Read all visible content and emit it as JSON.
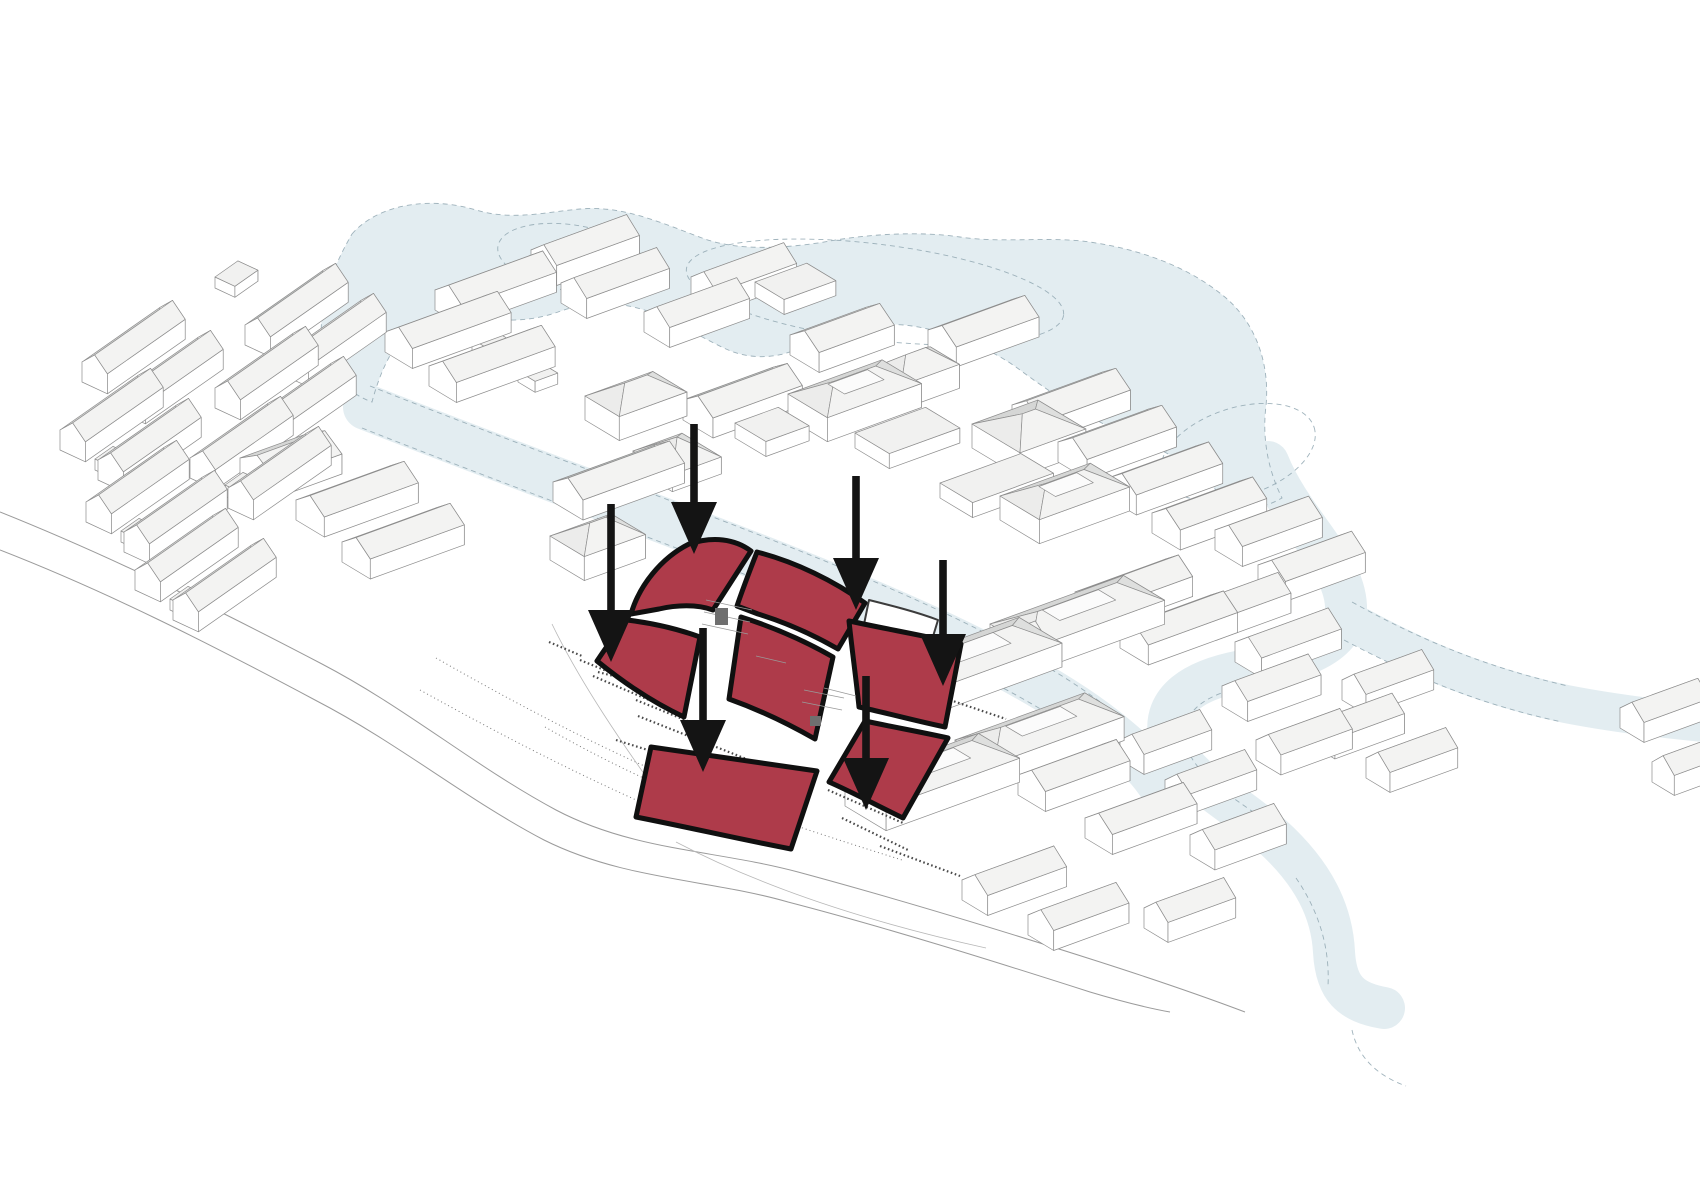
{
  "description": "Axonometric architectural site diagram: white city massing, pale blue lake and river, central site highlighted with red curved roofs and six black arrows",
  "canvas": {
    "w": 1700,
    "h": 1202,
    "background": "#ffffff"
  },
  "palette": {
    "water": "#E3EDF1",
    "water_edge": "#8FA6B0",
    "road": "#9B9B9B",
    "outline": "#8D8D8D",
    "wall": "#FFFFFF",
    "wall_side": "#F6F6F5",
    "roof_near": "#F3F3F2",
    "roof_far": "#D5D6D5",
    "roof_far_dark": "#BFC3C2",
    "roof_hip": "#ECECEB",
    "roof_hip2": "#DEDFDE",
    "roof_top": "#F1F1F0",
    "court": "#FBFBFB",
    "site_red": "#AE3B4A",
    "site_outline": "#101010",
    "arrow": "#141414",
    "detail": "#4A4A4A",
    "dots": "#777777",
    "plinth": "#B8B8B8"
  },
  "iso": {
    "u_deg": -20,
    "v_deg": 31
  },
  "water": {
    "lake": "M 352,234 C 378,204 430,196 476,210 C 512,221 546,212 580,209 C 622,205 662,223 702,238 C 740,252 790,248 830,241 C 870,234 920,231 960,237 C 1000,243 1042,237 1082,241 C 1132,247 1186,264 1226,298 C 1256,324 1270,364 1266,406 C 1262,438 1268,470 1282,498 C 1254,514 1232,508 1216,490 C 1196,468 1168,452 1138,440 C 1098,424 1058,398 1020,370 C 992,349 952,332 912,326 C 872,320 832,332 802,347 C 778,359 750,360 726,349 C 702,338 678,322 650,312 C 618,300 586,302 558,312 C 530,322 500,322 474,316 C 452,311 428,314 410,330 C 392,346 380,372 372,402 C 344,392 326,368 322,344 C 318,308 330,272 352,234 Z",
    "streams": [
      {
        "d": "M 1268,462 C 1292,522 1344,560 1346,606 C 1347,646 1300,660 1242,671 C 1194,680 1163,700 1169,736 C 1176,774 1230,799 1272,836 C 1314,874 1332,912 1334,952 C 1336,988 1350,1002 1384,1008",
        "w": 42
      },
      {
        "d": "M 366,407 C 500,460 644,512 786,568 C 902,614 1030,670 1106,730 C 1136,754 1154,772 1166,794",
        "w": 46
      },
      {
        "d": "M 1348,620 C 1420,660 1486,687 1566,704 C 1612,713 1662,719 1704,723",
        "w": 38
      }
    ],
    "islands": [
      {
        "cx": 572,
        "cy": 258,
        "rx": 75,
        "ry": 33,
        "rot": 9
      },
      {
        "cx": 875,
        "cy": 292,
        "rx": 190,
        "ry": 48,
        "rot": 7
      },
      {
        "cx": 1238,
        "cy": 452,
        "rx": 80,
        "ry": 44,
        "rot": -18
      }
    ],
    "edge_dashes": [
      "M 370,386 C 504,439 648,491 790,547 C 906,593 1034,649 1112,711",
      "M 362,428 C 496,481 640,533 782,589 C 898,635 1026,691 1100,749",
      "M 1352,602 C 1424,642 1490,668 1568,686",
      "M 1344,640 C 1416,678 1482,705 1562,722",
      "M 1238,688 C 1198,698 1180,716 1186,744 C 1194,778 1242,802 1284,834",
      "M 1296,878 C 1318,910 1330,946 1328,986",
      "M 1352,1030 C 1358,1058 1378,1076 1406,1086"
    ]
  },
  "roads": {
    "lines": [
      "M 0,512 C 110,556 215,608 322,664 C 408,709 474,766 556,810 C 634,851 716,850 798,872 C 898,899 1000,930 1100,962 C 1156,980 1208,998 1245,1012",
      "M 0,550 C 108,592 210,644 315,700 C 400,744 464,798 544,840 C 624,880 708,879 788,902 C 888,928 990,960 1090,992 C 1120,1001 1148,1008 1170,1012"
    ],
    "dotted": [
      "M 436,658 C 520,706 600,748 690,786 C 762,816 832,838 902,860",
      "M 545,727 C 620,770 700,806 790,836",
      "M 420,690 C 510,740 592,782 682,820"
    ]
  },
  "buildings": [
    [
      215,
      288,
      28,
      22,
      "f",
      "",
      -35,
      25
    ],
    [
      82,
      382,
      95,
      28,
      "g",
      "",
      -35,
      25
    ],
    [
      120,
      412,
      95,
      28,
      "g",
      "",
      -35,
      25
    ],
    [
      60,
      450,
      95,
      28,
      "g",
      "",
      -35,
      25
    ],
    [
      98,
      480,
      95,
      28,
      "g",
      "",
      -35,
      25
    ],
    [
      86,
      522,
      95,
      28,
      "g",
      "",
      -35,
      25
    ],
    [
      124,
      552,
      95,
      28,
      "g",
      "",
      -35,
      25
    ],
    [
      245,
      345,
      95,
      28,
      "g",
      "d",
      -35,
      25
    ],
    [
      283,
      375,
      95,
      28,
      "g",
      "",
      -35,
      25
    ],
    [
      215,
      408,
      95,
      28,
      "g",
      "",
      -35,
      25
    ],
    [
      253,
      438,
      95,
      28,
      "g",
      "",
      -35,
      25
    ],
    [
      190,
      478,
      95,
      28,
      "g",
      "",
      -35,
      25
    ],
    [
      228,
      508,
      95,
      28,
      "g",
      "",
      -35,
      25
    ],
    [
      135,
      590,
      95,
      28,
      "g",
      "",
      -35,
      25
    ],
    [
      173,
      620,
      95,
      28,
      "g",
      "",
      -35,
      25
    ],
    [
      117,
      402,
      22,
      18,
      "f",
      "",
      -35,
      25
    ],
    [
      95,
      470,
      22,
      18,
      "f",
      "",
      -35,
      25
    ],
    [
      121,
      542,
      22,
      18,
      "f",
      "",
      -35,
      25
    ],
    [
      280,
      365,
      22,
      18,
      "f",
      "",
      -35,
      25
    ],
    [
      250,
      428,
      22,
      18,
      "f",
      "",
      -35,
      25
    ],
    [
      225,
      496,
      22,
      18,
      "f",
      "",
      -35,
      25
    ],
    [
      170,
      610,
      22,
      18,
      "f",
      "",
      -35,
      25
    ],
    [
      240,
      478,
      72,
      40,
      "g",
      ""
    ],
    [
      296,
      520,
      100,
      33,
      "g",
      ""
    ],
    [
      342,
      562,
      100,
      33,
      "g",
      "d"
    ],
    [
      435,
      310,
      100,
      32,
      "g",
      ""
    ],
    [
      385,
      352,
      105,
      32,
      "g",
      ""
    ],
    [
      429,
      386,
      105,
      32,
      "g",
      ""
    ],
    [
      531,
      270,
      88,
      30,
      "g",
      ""
    ],
    [
      561,
      303,
      88,
      30,
      "g",
      ""
    ],
    [
      472,
      350,
      24,
      20,
      "f",
      ""
    ],
    [
      518,
      382,
      24,
      20,
      "f",
      ""
    ],
    [
      644,
      332,
      85,
      30,
      "g",
      ""
    ],
    [
      691,
      297,
      85,
      30,
      "g",
      ""
    ],
    [
      755,
      297,
      55,
      34,
      "f",
      ""
    ],
    [
      553,
      502,
      108,
      35,
      "g",
      "d"
    ],
    [
      550,
      560,
      65,
      40,
      "h",
      ""
    ],
    [
      585,
      420,
      72,
      40,
      "h",
      ""
    ],
    [
      633,
      468,
      52,
      46,
      "p",
      ""
    ],
    [
      683,
      420,
      95,
      35,
      "g",
      "d"
    ],
    [
      735,
      438,
      46,
      36,
      "f",
      ""
    ],
    [
      790,
      355,
      80,
      34,
      "g",
      ""
    ],
    [
      788,
      418,
      100,
      46,
      "h",
      "c"
    ],
    [
      855,
      448,
      75,
      40,
      "f",
      ""
    ],
    [
      872,
      392,
      62,
      34,
      "h",
      ""
    ],
    [
      928,
      350,
      88,
      33,
      "g",
      ""
    ],
    [
      972,
      448,
      70,
      56,
      "h",
      ""
    ],
    [
      940,
      498,
      86,
      38,
      "f",
      ""
    ],
    [
      1000,
      520,
      96,
      46,
      "h",
      "c"
    ],
    [
      1012,
      425,
      95,
      34,
      "g",
      "d"
    ],
    [
      1058,
      462,
      95,
      34,
      "g",
      "d"
    ],
    [
      1108,
      498,
      92,
      33,
      "g",
      ""
    ],
    [
      1152,
      533,
      92,
      33,
      "g",
      ""
    ],
    [
      1215,
      550,
      85,
      32,
      "g",
      ""
    ],
    [
      1258,
      585,
      85,
      32,
      "g",
      ""
    ],
    [
      1075,
      612,
      95,
      33,
      "g",
      ""
    ],
    [
      1120,
      648,
      95,
      33,
      "g",
      ""
    ],
    [
      1190,
      625,
      80,
      30,
      "g",
      ""
    ],
    [
      1235,
      662,
      85,
      31,
      "g",
      ""
    ],
    [
      880,
      692,
      148,
      50,
      "h",
      "c"
    ],
    [
      990,
      648,
      142,
      48,
      "h",
      "c"
    ],
    [
      845,
      806,
      142,
      48,
      "h",
      "c"
    ],
    [
      955,
      764,
      138,
      46,
      "h",
      "c"
    ],
    [
      1018,
      795,
      90,
      32,
      "g",
      ""
    ],
    [
      1085,
      838,
      90,
      32,
      "g",
      ""
    ],
    [
      962,
      900,
      84,
      30,
      "g",
      ""
    ],
    [
      1028,
      935,
      80,
      30,
      "g",
      ""
    ],
    [
      1120,
      760,
      72,
      28,
      "g",
      ""
    ],
    [
      1165,
      800,
      72,
      28,
      "g",
      ""
    ],
    [
      1190,
      855,
      76,
      29,
      "g",
      ""
    ],
    [
      1144,
      928,
      72,
      28,
      "g",
      ""
    ],
    [
      1222,
      706,
      78,
      30,
      "g",
      ""
    ],
    [
      1256,
      760,
      76,
      29,
      "g",
      ""
    ],
    [
      1310,
      744,
      74,
      29,
      "g",
      ""
    ],
    [
      1342,
      700,
      72,
      28,
      "g",
      ""
    ],
    [
      1366,
      778,
      72,
      28,
      "g",
      ""
    ],
    [
      1620,
      728,
      70,
      28,
      "g",
      ""
    ],
    [
      1652,
      782,
      66,
      26,
      "g",
      ""
    ],
    [
      952,
      672,
      75,
      30,
      "g",
      ""
    ]
  ],
  "site": {
    "red_pieces": [
      {
        "name": "roof-top-left",
        "d": "M 689,544 C 713,536 735,539 751,551 L 713,610 C 697,604 676,605 659,609 L 631,614 C 639,586 661,558 689,544 Z"
      },
      {
        "name": "roof-top-right",
        "d": "M 757,552 C 796,562 834,581 865,603 L 838,649 C 812,634 784,622 758,614 L 737,606 C 743,588 750,570 757,552 Z"
      },
      {
        "name": "roof-left",
        "d": "M 627,620 C 652,623 678,629 700,637 L 684,717 C 654,703 624,683 597,661 C 607,646 617,632 627,620 Z"
      },
      {
        "name": "roof-center",
        "d": "M 741,617 C 773,627 805,641 833,657 L 815,739 C 787,723 757,709 729,699 C 733,671 737,644 741,617 Z"
      },
      {
        "name": "roof-right",
        "d": "M 849,621 C 887,629 925,636 961,644 L 945,727 C 916,721 887,713 859,707 C 856,678 852,650 849,621 Z"
      },
      {
        "name": "roof-bottom-right",
        "d": "M 865,721 C 893,727 921,732 948,738 L 903,818 C 878,806 852,792 829,782 C 841,762 853,741 865,721 Z"
      },
      {
        "name": "roof-bottom",
        "d": "M 651,747 C 707,755 763,763 817,771 L 791,849 C 739,839 687,827 636,817 C 641,794 646,770 651,747 Z"
      }
    ],
    "white_pieces": [
      {
        "d": "M 869,600 C 893,606 917,612 938,620 L 928,653 C 906,645 884,638 862,634 Z"
      }
    ],
    "courtyard_marks": [
      "M 706,600 L 752,610",
      "M 704,612 L 750,622",
      "M 702,624 L 748,634",
      "M 756,656 L 786,663",
      "M 804,690 L 844,698",
      "M 802,702 L 842,710",
      "M 824,688 L 856,696"
    ],
    "hatch_rects": [
      {
        "x": 715,
        "y": 608,
        "w": 13,
        "h": 17
      },
      {
        "x": 810,
        "y": 716,
        "w": 11,
        "h": 10
      }
    ],
    "tick_rows": [
      "M 549,642 L 582,656",
      "M 580,660 L 648,688",
      "M 593,676 L 649,700",
      "M 636,700 L 690,722",
      "M 638,716 L 754,762",
      "M 616,740 L 753,783",
      "M 705,770 L 806,801",
      "M 828,790 L 903,823",
      "M 842,818 L 908,850",
      "M 880,846 L 960,876",
      "M 950,700 L 1006,719",
      "M 598,672 L 690,696"
    ],
    "plinth_lines": [
      "M 552,624 C 580,682 622,744 670,810",
      "M 676,842 C 764,888 868,922 986,948"
    ]
  },
  "arrows": [
    {
      "x": 694,
      "y0": 424,
      "tip": 554
    },
    {
      "x": 856,
      "y0": 476,
      "tip": 610
    },
    {
      "x": 611,
      "y0": 504,
      "tip": 662
    },
    {
      "x": 943,
      "y0": 560,
      "tip": 686
    },
    {
      "x": 703,
      "y0": 628,
      "tip": 772
    },
    {
      "x": 866,
      "y0": 676,
      "tip": 810
    }
  ]
}
